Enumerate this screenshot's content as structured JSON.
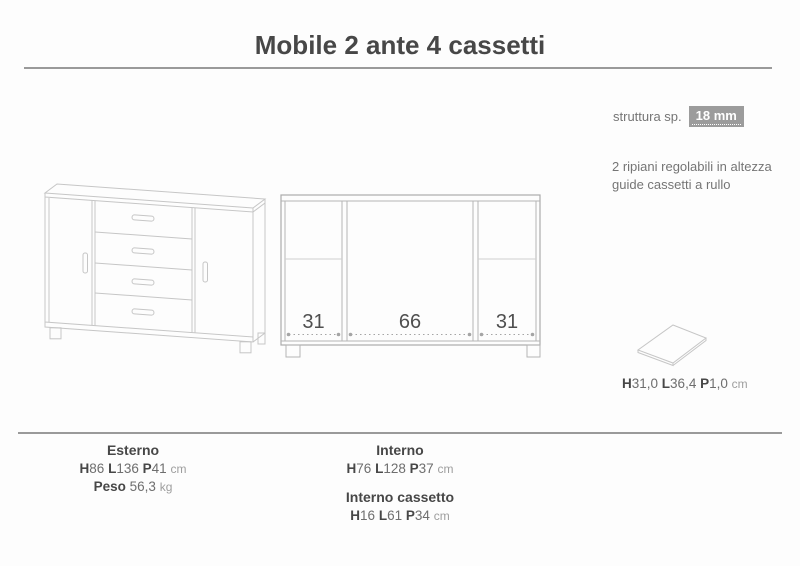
{
  "title": "Mobile 2 ante 4 cassetti",
  "specs": {
    "struttura_label": "struttura sp.",
    "struttura_value": "18 mm",
    "feature_line1": "2 ripiani regolabili in altezza",
    "feature_line2": "guide cassetti a rullo"
  },
  "schematic": {
    "left_section_width": "31",
    "center_section_width": "66",
    "right_section_width": "31"
  },
  "shelf": {
    "h_label": "H",
    "h_value": "31,0",
    "l_label": "L",
    "l_value": "36,4",
    "p_label": "P",
    "p_value": "1,0",
    "unit": "cm"
  },
  "footer": {
    "esterno": {
      "title": "Esterno",
      "h_label": "H",
      "h_value": "86",
      "l_label": "L",
      "l_value": "136",
      "p_label": "P",
      "p_value": "41",
      "unit": "cm",
      "peso_label": "Peso",
      "peso_value": "56,3",
      "peso_unit": "kg"
    },
    "interno": {
      "title": "Interno",
      "h_label": "H",
      "h_value": "76",
      "l_label": "L",
      "l_value": "128",
      "p_label": "P",
      "p_value": "37",
      "unit": "cm"
    },
    "interno_cassetto": {
      "title": "Interno cassetto",
      "h_label": "H",
      "h_value": "16",
      "l_label": "L",
      "l_value": "61",
      "p_label": "P",
      "p_value": "34",
      "unit": "cm"
    }
  },
  "colors": {
    "badge_gray": "#9c9c9c",
    "text_dark": "#474747",
    "text_mid": "#6e6e6e",
    "text_light": "#9e9e9e",
    "drawing_line": "#c6c6c6",
    "schematic_line": "#ababab"
  }
}
